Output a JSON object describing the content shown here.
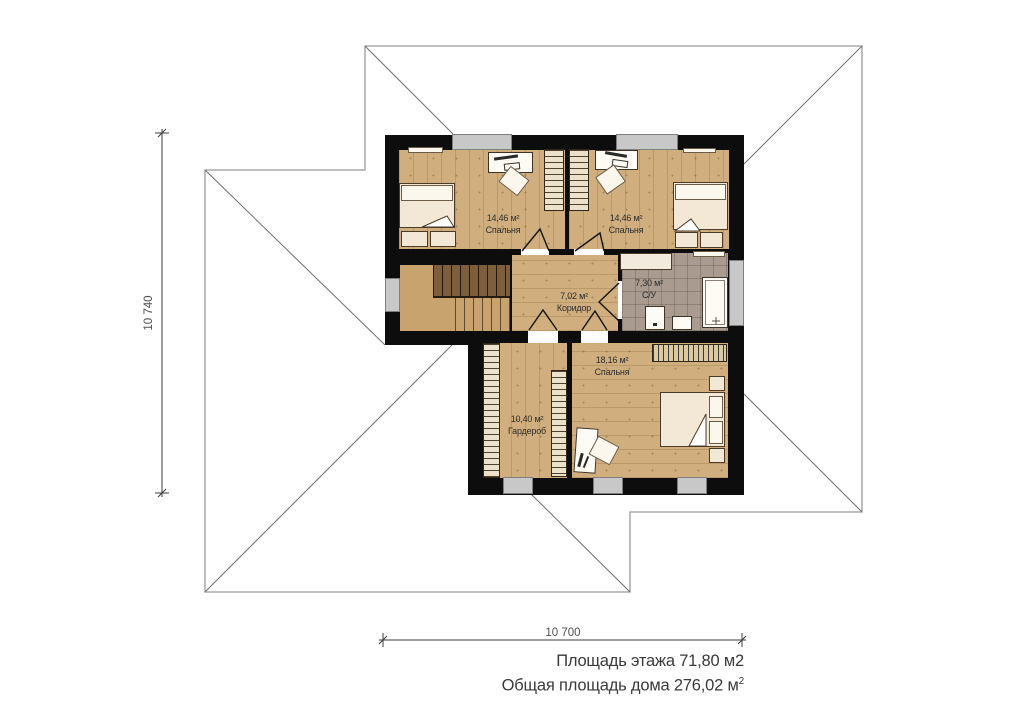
{
  "rooms": [
    {
      "area": "14,46 м²",
      "name": "Спальня"
    },
    {
      "area": "14,46 м²",
      "name": "Спальня"
    },
    {
      "area": "7,02 м²",
      "name": "Коридор"
    },
    {
      "area": "7,30 м²",
      "name": "С/У"
    },
    {
      "area": "10,40 м²",
      "name": "Гардероб"
    },
    {
      "area": "18,16 м²",
      "name": "Спальня"
    }
  ],
  "dimensions": {
    "left": "10 740",
    "bottom": "10 700"
  },
  "summary": {
    "line1": "Площадь этажа 71,80 м2",
    "line2_text": "Общая площадь дома 276,02 м",
    "line2_sup": "2"
  },
  "colors": {
    "wall": "#0d0d0d",
    "wood_floor": "#d0ae7d",
    "tile_floor": "#a99b8f",
    "roof_line": "#9a9a9a",
    "hip_line": "#6e6e6e",
    "dim_line": "#3c3c3c"
  }
}
